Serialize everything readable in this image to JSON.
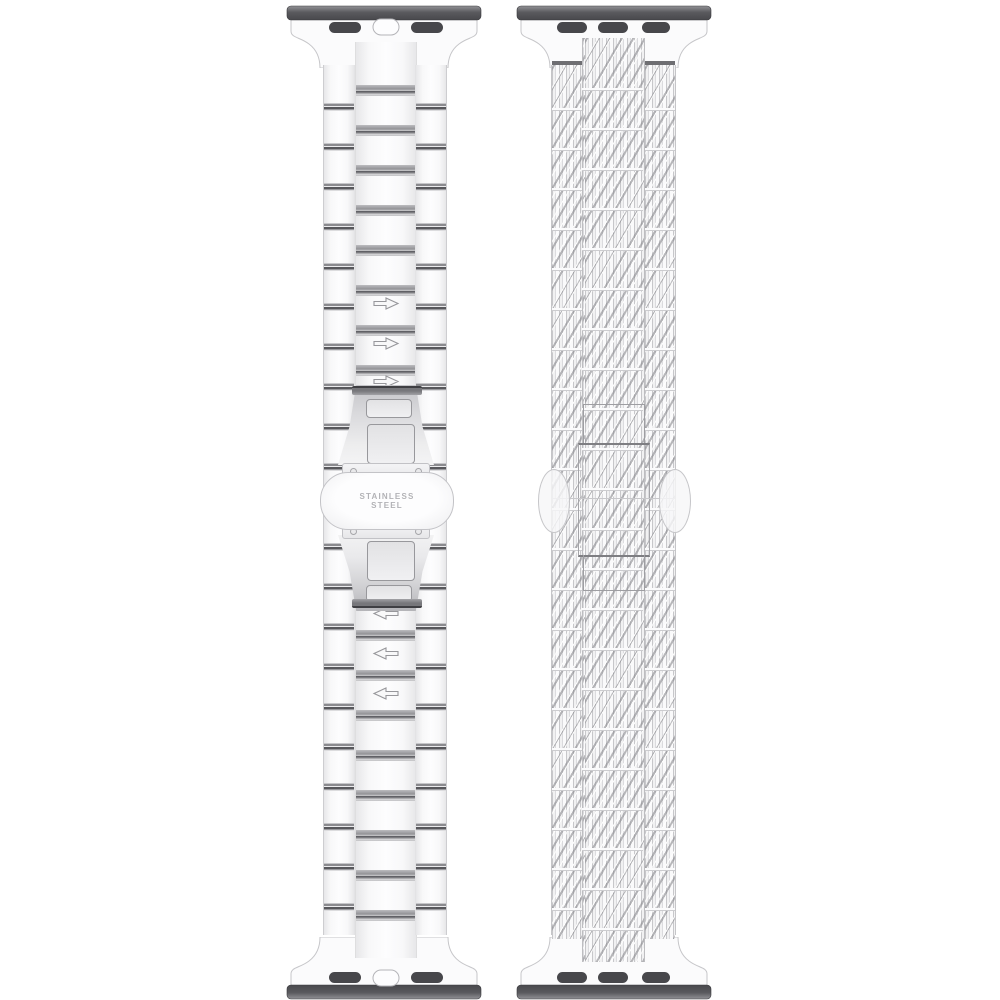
{
  "page": {
    "title": "Stainless steel watch band - front and back views",
    "background": "#ffffff"
  },
  "left_band": {
    "view": "front",
    "style": "three-link bracelet",
    "adapter_top": {
      "slot_count": 2,
      "has_center_button": true
    },
    "adapter_bottom": {
      "slot_count": 2,
      "has_center_button": true
    },
    "arrows_upper": {
      "direction": "right",
      "count": 3,
      "icon": "arrow-right-icon"
    },
    "arrows_lower": {
      "direction": "left",
      "count": 3,
      "icon": "arrow-left-icon"
    },
    "clasp": {
      "type": "butterfly deployant",
      "engraving_line1": "STAINLESS",
      "engraving_line2": "STEEL"
    }
  },
  "right_band": {
    "view": "back",
    "style": "woven mesh texture",
    "adapter_top": {
      "slot_count": 3,
      "has_center_button": false
    },
    "adapter_bottom": {
      "slot_count": 3,
      "has_center_button": false
    }
  },
  "colors": {
    "background": "#ffffff",
    "metal_light": "#f8f8f9",
    "metal_shadow": "#8a8a8e",
    "slot_fill": "#47474b",
    "dark_bar": "#55555a",
    "engraving_text": "#b2b2b6",
    "mesh_line": "#8a8a8f"
  }
}
